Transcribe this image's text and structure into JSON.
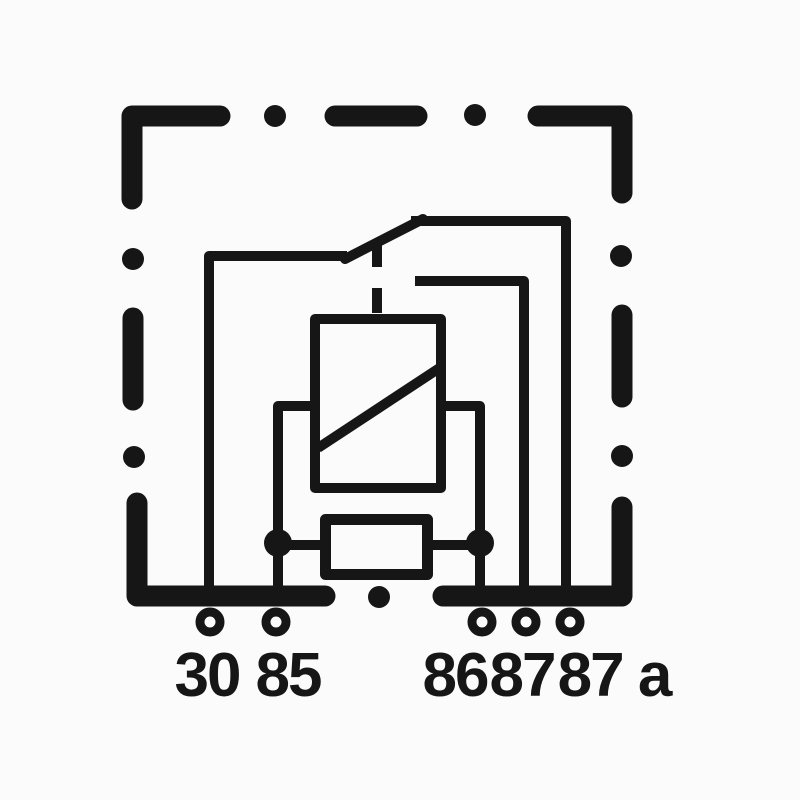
{
  "figure": {
    "kind": "relay-wiring-diagram",
    "colors": {
      "ink": "#161616",
      "background": "#fbfbfb"
    },
    "terminals": [
      {
        "id": "30",
        "label": "30"
      },
      {
        "id": "85",
        "label": "85"
      },
      {
        "id": "86",
        "label": "86"
      },
      {
        "id": "87",
        "label": "87"
      },
      {
        "id": "87a",
        "label": "87 a"
      }
    ]
  }
}
